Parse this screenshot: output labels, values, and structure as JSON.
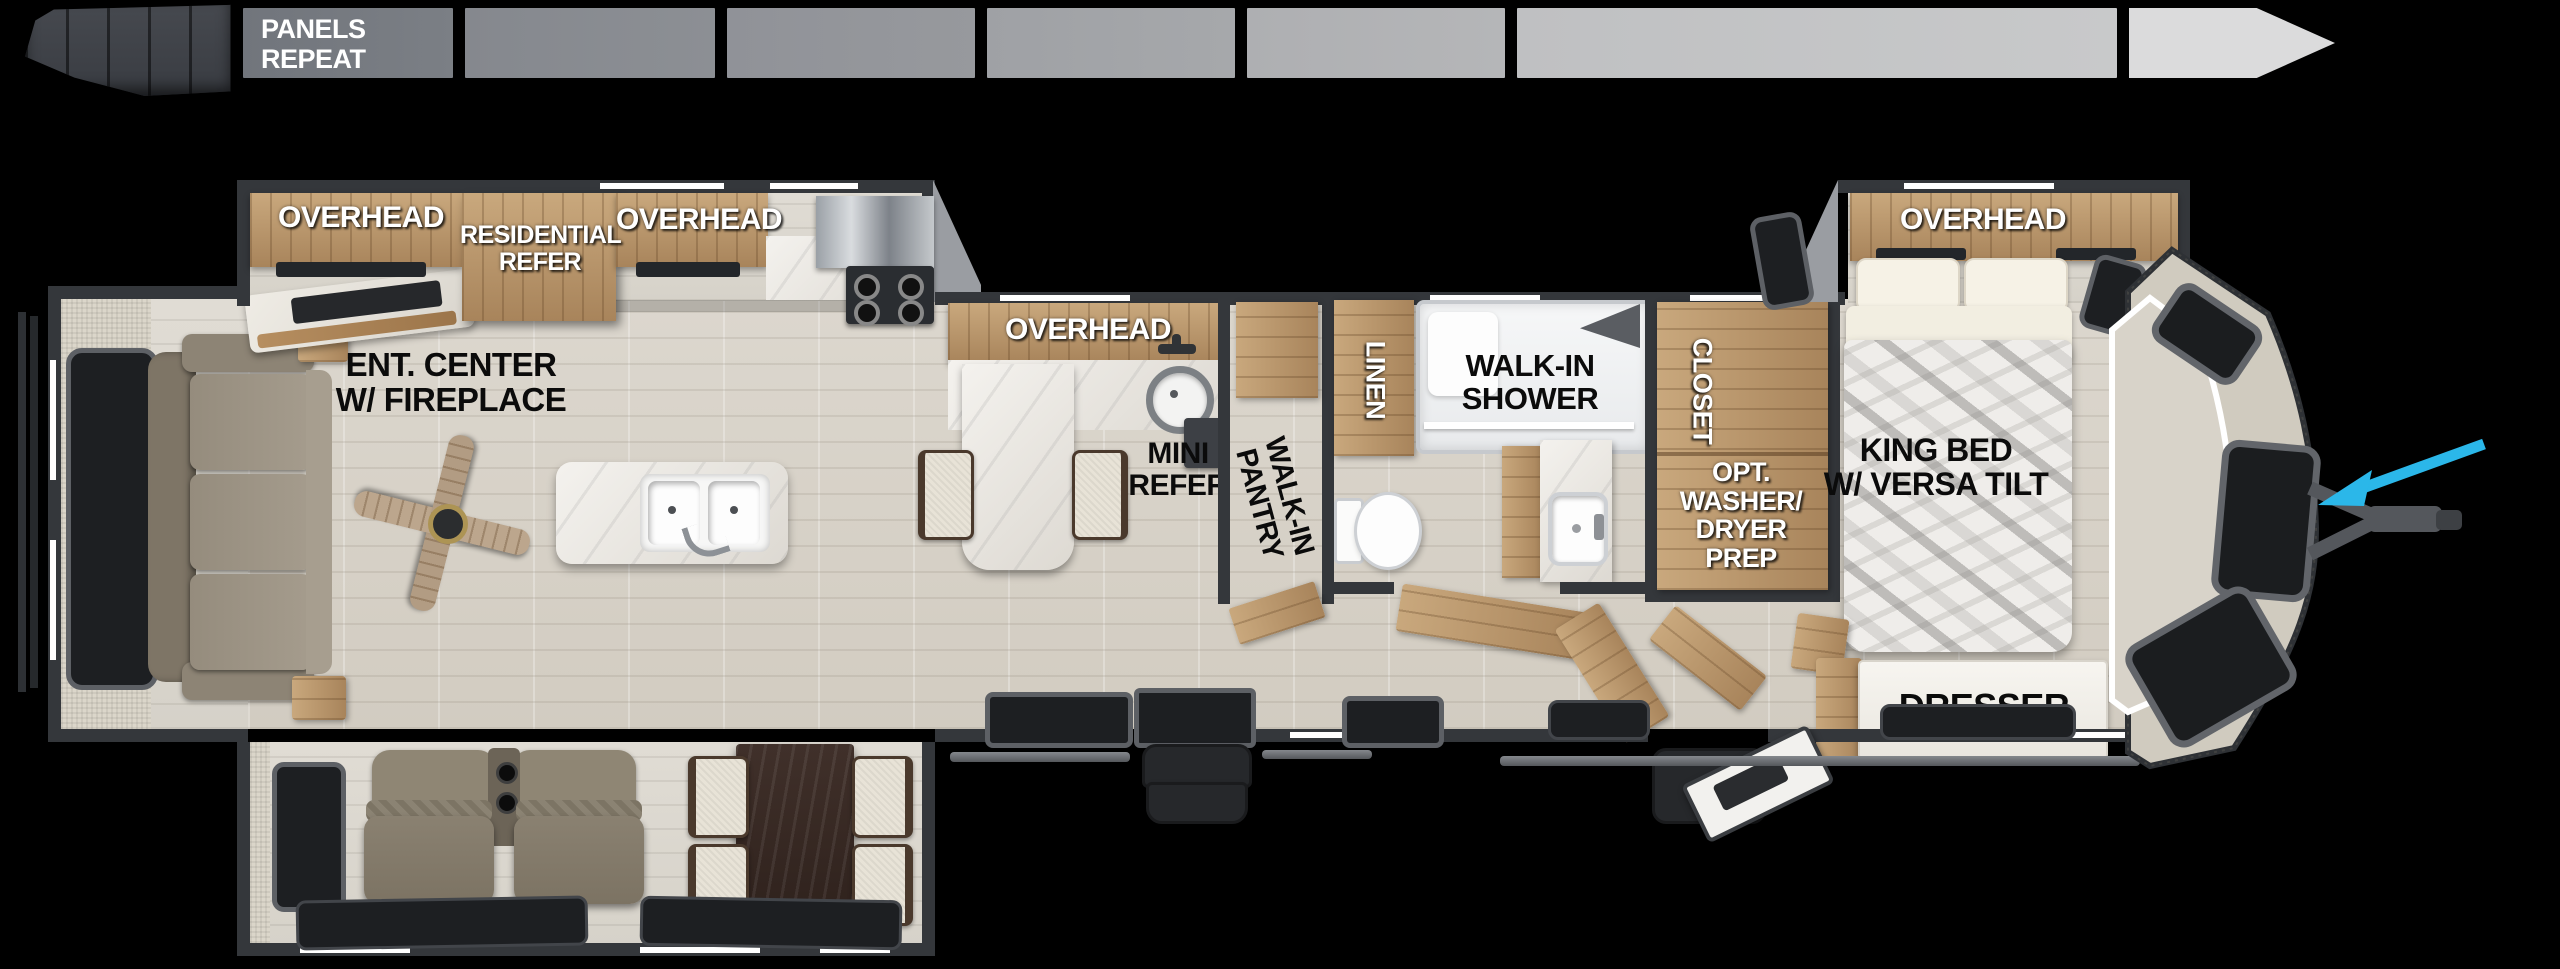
{
  "banner": {
    "label": "PANELS\nREPEAT",
    "segment_colors": [
      "#73777e",
      "#878a90",
      "#93959a",
      "#a2a4a7",
      "#b1b2b4",
      "#c2c3c5"
    ],
    "arrow_color": "#dbdbdc"
  },
  "rooms": {
    "rear_slide": {
      "overhead_left": "OVERHEAD",
      "refer": "RESIDENTIAL\nREFER",
      "overhead_right": "OVERHEAD"
    },
    "living": {
      "ent_center": "ENT. CENTER\nW/ FIREPLACE"
    },
    "kitchen": {
      "overhead": "OVERHEAD",
      "mini_refer": "MINI\nREFER",
      "pantry": "WALK-IN\nPANTRY"
    },
    "bath": {
      "linen": "LINEN",
      "shower": "WALK-IN\nSHOWER"
    },
    "bedroom": {
      "closet": "CLOSET",
      "washer_prep": "OPT.\nWASHER/\nDRYER\nPREP",
      "overhead": "OVERHEAD",
      "bed": "KING BED\nW/ VERSA TILT",
      "dresser": "DRESSER"
    }
  },
  "colors": {
    "pointer_arrow": "#2bb7e9",
    "wall": "#34373b",
    "cap_fabric": "#d0cbbf",
    "wood": "#b8916a",
    "floor": "#d8d3c9"
  }
}
